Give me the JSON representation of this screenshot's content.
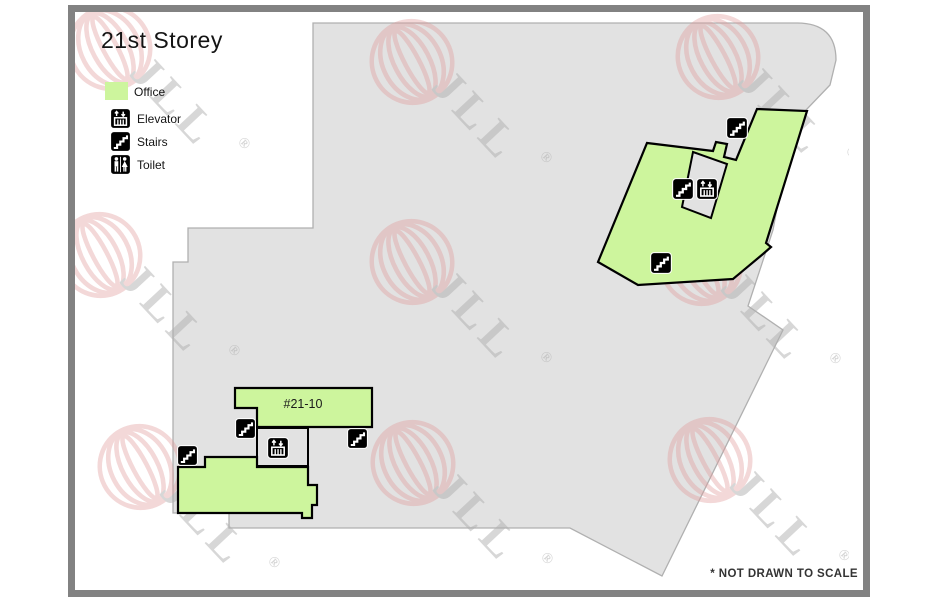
{
  "page": {
    "title": "21st Storey",
    "footer_note": "* NOT DRAWN TO SCALE"
  },
  "legend": {
    "items": [
      {
        "icon": "office-swatch",
        "label": "Office"
      },
      {
        "icon": "elevator-icon",
        "label": "Elevator"
      },
      {
        "icon": "stairs-icon",
        "label": "Stairs"
      },
      {
        "icon": "toilet-icon",
        "label": "Toilet"
      }
    ]
  },
  "units": {
    "office_2110": "#21-10"
  },
  "watermark": {
    "text": "JLL",
    "registered": "®"
  },
  "colors": {
    "office_green": "#cdf59d",
    "floor_gray": "#e2e2e2",
    "floor_outline": "#b0b0b0",
    "shape_outline_black": "#000000",
    "frame_gray": "#828282",
    "watermark_red": "#e09a9a",
    "watermark_gray": "#aeaeae",
    "text_black": "#141414",
    "footer_gray": "#333333"
  }
}
